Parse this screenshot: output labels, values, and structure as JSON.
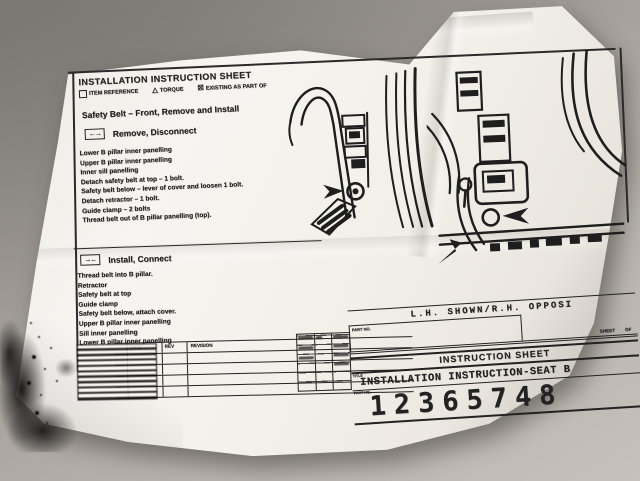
{
  "sheet": {
    "header": {
      "title": "INSTALLATION INSTRUCTION SHEET",
      "legend": [
        {
          "icon": "item-reference-box",
          "label": "ITEM REFERENCE"
        },
        {
          "icon": "torque-triangle",
          "symbol": "△",
          "label": "TORQUE"
        },
        {
          "icon": "existing-checkbox",
          "symbol": "☒",
          "label": "EXISTING AS PART OF"
        }
      ]
    },
    "subject": "Safety Belt  –  Front, Remove and Install",
    "remove_section": {
      "icon": "←→",
      "title": "Remove, Disconnect",
      "steps": [
        "Lower B pillar inner panelling",
        "Upper B pillar inner panelling",
        "Inner sill panelling",
        "Detach safety belt at top  –  1 bolt.",
        "Safety belt below  –  lever of cover and loosen 1 bolt.",
        "Detach retractor  –  1 bolt.",
        "Guide clamp  –  2 bolts",
        "Thread belt out of B pillar panelling (top)."
      ]
    },
    "install_section": {
      "icon": "→←",
      "title": "Install, Connect",
      "steps": [
        "Thread belt into B pillar.",
        "Retractor",
        "Safety belt at top",
        "Guide clamp",
        "Safety belt below, attach cover.",
        "Upper B pillar inner panelling",
        "Sill inner panelling",
        "Lower B pillar inner panelling"
      ]
    },
    "orientation_note": {
      "text": "L.H. SHOWN/R.H. OPPOSI",
      "part_no_label": "PART NO.",
      "sheet_label": "SHEET",
      "of_label": "OF"
    },
    "title_block": {
      "band": "INSTRUCTION SHEET",
      "title_label": "TITLE",
      "title": "INSTALLATION INSTRUCTION-SEAT B",
      "part_no_label": "PART NO.",
      "part_number": "12365748",
      "revision_table": {
        "headers": [
          "DATE",
          "REV",
          "REVISION"
        ],
        "empty_rows": 4
      }
    }
  },
  "colors": {
    "paper": "#f4f1ec",
    "ink": "#222222",
    "desk": "#a7a29c"
  }
}
